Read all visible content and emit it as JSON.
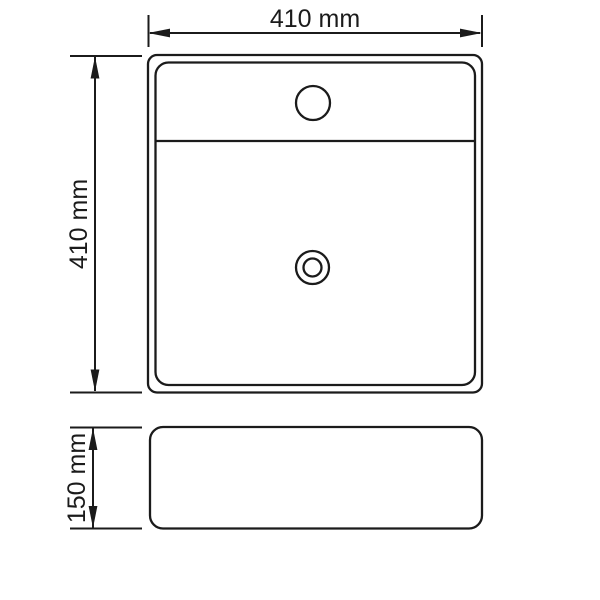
{
  "page": {
    "background_color": "#ffffff",
    "line_color": "#1b1b1b"
  },
  "diagram": {
    "type": "technical-dimension-drawing",
    "views": {
      "top_view": {
        "name": "top-view",
        "features": [
          "faucet-hole",
          "deck-divider-line",
          "drain-hole-with-overflow-ring"
        ]
      },
      "side_view": {
        "name": "side-view",
        "features": [
          "rounded-profile"
        ]
      }
    },
    "dimensions": {
      "width": {
        "label": "410 mm",
        "value_mm": 410,
        "orientation": "horizontal"
      },
      "depth": {
        "label": "410 mm",
        "value_mm": 410,
        "orientation": "vertical"
      },
      "height": {
        "label": "150 mm",
        "value_mm": 150,
        "orientation": "vertical"
      }
    }
  }
}
